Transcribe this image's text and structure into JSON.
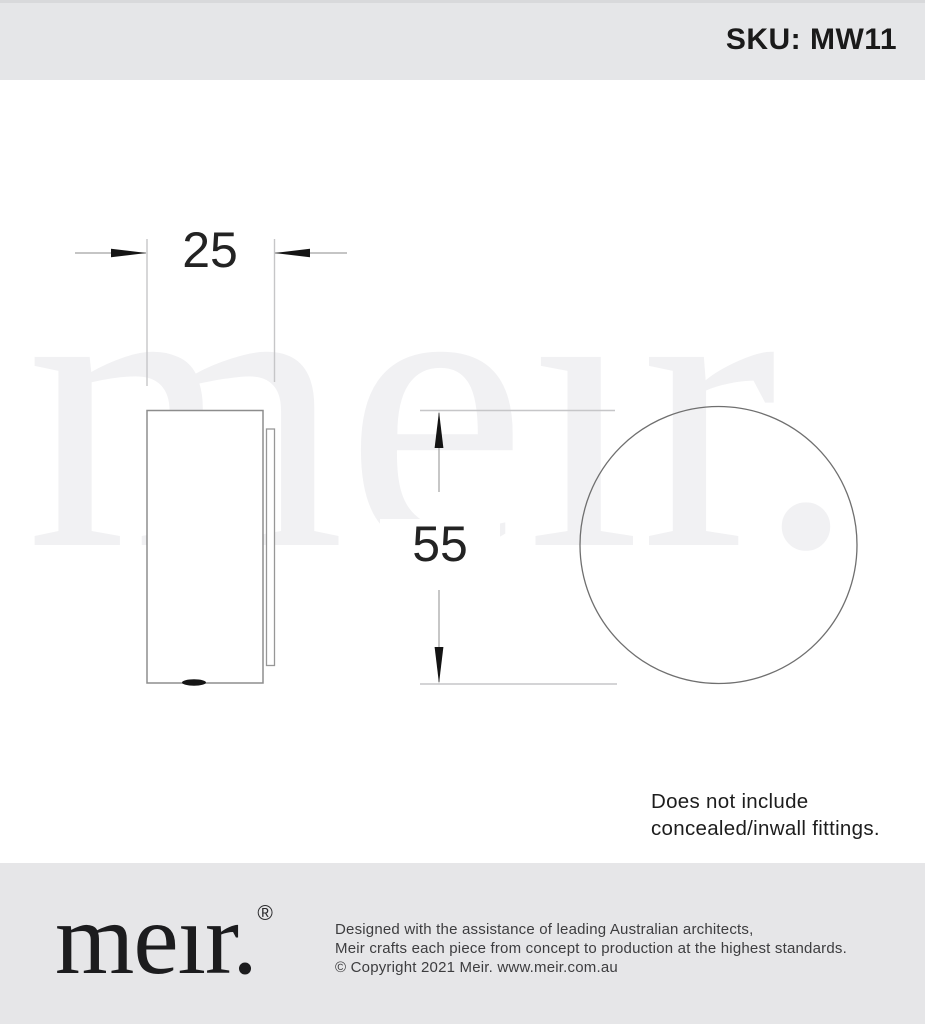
{
  "header": {
    "sku": "SKU: MW11"
  },
  "watermark": {
    "text": "meır."
  },
  "drawing": {
    "width_dimension": "25",
    "height_dimension": "55"
  },
  "note": {
    "line1": "Does not include",
    "line2": "concealed/inwall fittings."
  },
  "footer": {
    "logo": "meır.",
    "registered": "®",
    "line1": "Designed with the assistance of leading Australian architects,",
    "line2": "Meir crafts each piece from concept to production at the highest standards.",
    "line3": "© Copyright 2021 Meir. www.meir.com.au"
  },
  "colors": {
    "header_bg": "#e5e6e8",
    "footer_bg": "#e6e6e8",
    "watermark": "#f1f1f3",
    "outline_gray": "#8d8d8d",
    "dimension_gray": "#a2a2a2",
    "extension_gray": "#c6c6c8",
    "arrow_black": "#141414",
    "text_black": "#1a1a1a"
  }
}
